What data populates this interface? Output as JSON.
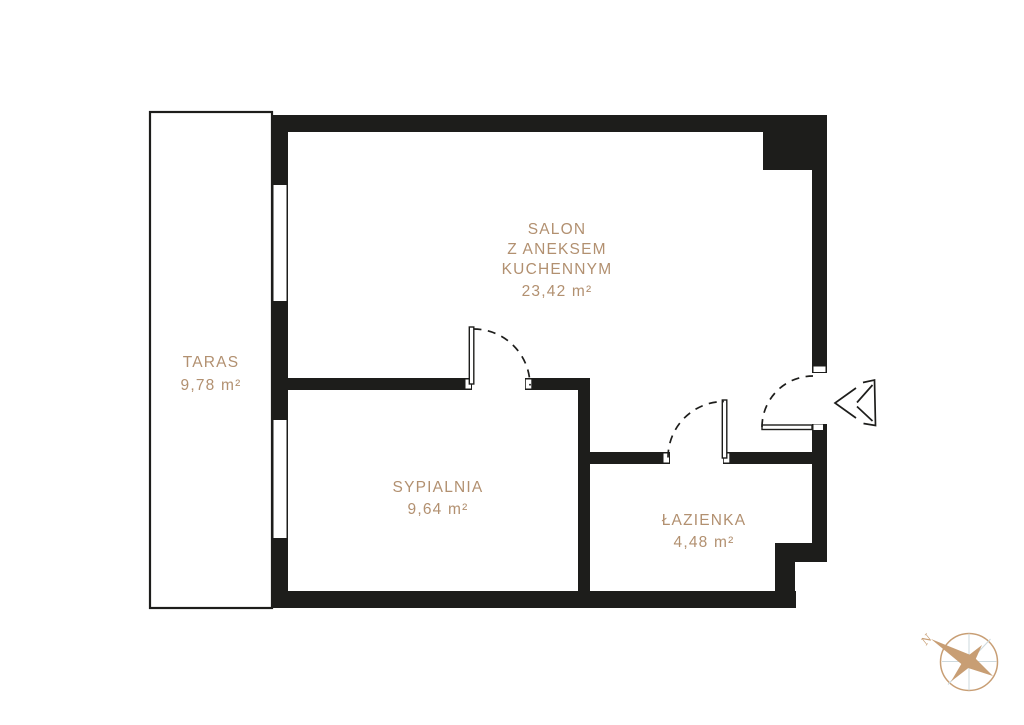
{
  "rooms": [
    {
      "id": "taras",
      "label": "TARAS",
      "area": "9,78 m²"
    },
    {
      "id": "salon",
      "label_lines": [
        "SALON",
        "Z ANEKSEM",
        "KUCHENNYM"
      ],
      "area": "23,42 m²"
    },
    {
      "id": "sypialnia",
      "label": "SYPIALNIA",
      "area": "9,64 m²"
    },
    {
      "id": "lazienka",
      "label": "ŁAZIENKA",
      "area": "4,48 m²"
    }
  ],
  "compass": {
    "north_label": "N"
  },
  "colors": {
    "wall": "#1d1d1b",
    "room_label": "#b29070",
    "compass_accent": "#c89e74",
    "compass_detail": "#cdd9de",
    "background": "#ffffff"
  }
}
